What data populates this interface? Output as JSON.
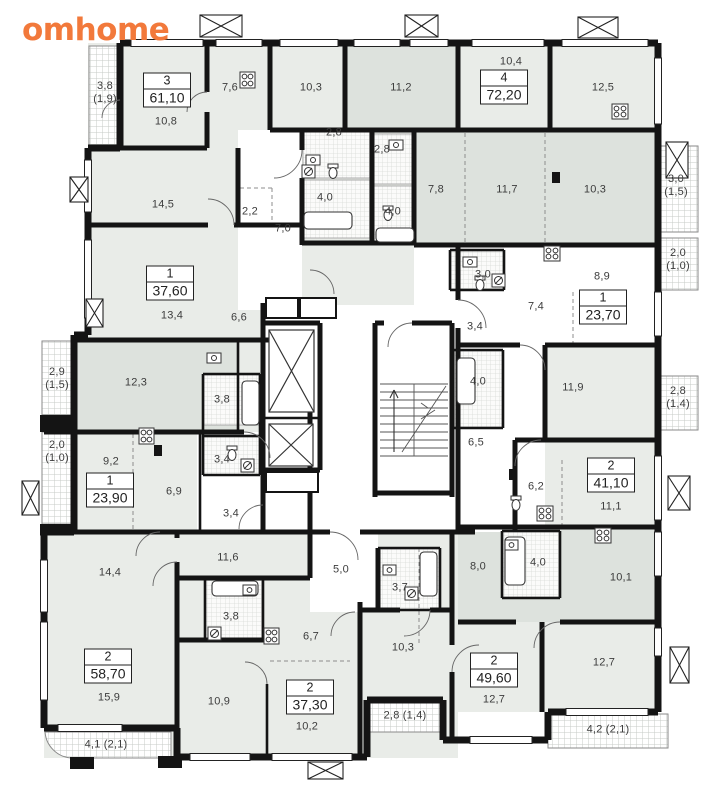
{
  "logo": {
    "text": "omhome",
    "color": "#F2793B"
  },
  "plan": {
    "wall_color": "#141414",
    "room_fill": "#e9ece8",
    "room_fill_dark": "#dde2dd",
    "corridor_fill": "#ffffff",
    "apartments": [
      {
        "number": "3",
        "area": "61,10",
        "x": 167,
        "y": 90
      },
      {
        "number": "4",
        "area": "72,20",
        "x": 504,
        "y": 87
      },
      {
        "number": "1",
        "area": "37,60",
        "x": 170,
        "y": 283
      },
      {
        "number": "1",
        "area": "23,70",
        "x": 603,
        "y": 307
      },
      {
        "number": "1",
        "area": "23,90",
        "x": 110,
        "y": 490
      },
      {
        "number": "2",
        "area": "41,10",
        "x": 611,
        "y": 475
      },
      {
        "number": "2",
        "area": "58,70",
        "x": 108,
        "y": 666
      },
      {
        "number": "2",
        "area": "37,30",
        "x": 310,
        "y": 697
      },
      {
        "number": "2",
        "area": "49,60",
        "x": 494,
        "y": 670
      }
    ],
    "rooms": [
      {
        "label": "3,8\n(1,9)",
        "x": 105,
        "y": 93
      },
      {
        "label": "10,8",
        "x": 166,
        "y": 122
      },
      {
        "label": "7,6",
        "x": 230,
        "y": 88
      },
      {
        "label": "10,3",
        "x": 311,
        "y": 88
      },
      {
        "label": "11,2",
        "x": 401,
        "y": 88
      },
      {
        "label": "2,8",
        "x": 334,
        "y": 133
      },
      {
        "label": "2,8",
        "x": 382,
        "y": 150
      },
      {
        "label": "10,4",
        "x": 511,
        "y": 62
      },
      {
        "label": "12,5",
        "x": 603,
        "y": 88
      },
      {
        "label": "14,5",
        "x": 163,
        "y": 205
      },
      {
        "label": "2,2",
        "x": 250,
        "y": 212
      },
      {
        "label": "7,0",
        "x": 283,
        "y": 229
      },
      {
        "label": "4,0",
        "x": 325,
        "y": 198
      },
      {
        "label": "4,0",
        "x": 393,
        "y": 212
      },
      {
        "label": "7,8",
        "x": 436,
        "y": 190
      },
      {
        "label": "11,7",
        "x": 507,
        "y": 190
      },
      {
        "label": "10,3",
        "x": 595,
        "y": 190
      },
      {
        "label": "3,0\n(1,5)",
        "x": 676,
        "y": 186
      },
      {
        "label": "2,0\n(1,0)",
        "x": 678,
        "y": 260
      },
      {
        "label": "8,9",
        "x": 602,
        "y": 277
      },
      {
        "label": "3,0",
        "x": 483,
        "y": 275
      },
      {
        "label": "7,4",
        "x": 536,
        "y": 307
      },
      {
        "label": "3,4",
        "x": 475,
        "y": 327
      },
      {
        "label": "13,4",
        "x": 172,
        "y": 316
      },
      {
        "label": "6,6",
        "x": 239,
        "y": 318
      },
      {
        "label": "12,3",
        "x": 136,
        "y": 383
      },
      {
        "label": "3,8",
        "x": 222,
        "y": 400
      },
      {
        "label": "2,9\n(1,5)",
        "x": 57,
        "y": 379
      },
      {
        "label": "2,0\n(1,0)",
        "x": 57,
        "y": 452
      },
      {
        "label": "3,4",
        "x": 222,
        "y": 460
      },
      {
        "label": "9,2",
        "x": 111,
        "y": 462
      },
      {
        "label": "6,9",
        "x": 174,
        "y": 492
      },
      {
        "label": "3,4",
        "x": 231,
        "y": 514
      },
      {
        "label": "11,9",
        "x": 573,
        "y": 388
      },
      {
        "label": "2,8\n(1,4)",
        "x": 678,
        "y": 398
      },
      {
        "label": "6,5",
        "x": 476,
        "y": 443
      },
      {
        "label": "6,2",
        "x": 536,
        "y": 487
      },
      {
        "label": "11,1",
        "x": 611,
        "y": 507
      },
      {
        "label": "4,0",
        "x": 478,
        "y": 382
      },
      {
        "label": "8,0",
        "x": 478,
        "y": 567
      },
      {
        "label": "4,0",
        "x": 538,
        "y": 563
      },
      {
        "label": "10,1",
        "x": 621,
        "y": 578
      },
      {
        "label": "14,4",
        "x": 110,
        "y": 573
      },
      {
        "label": "11,6",
        "x": 228,
        "y": 558
      },
      {
        "label": "5,0",
        "x": 341,
        "y": 570
      },
      {
        "label": "3,7",
        "x": 400,
        "y": 588
      },
      {
        "label": "3,8",
        "x": 231,
        "y": 617
      },
      {
        "label": "6,7",
        "x": 311,
        "y": 637
      },
      {
        "label": "10,3",
        "x": 403,
        "y": 648
      },
      {
        "label": "15,9",
        "x": 109,
        "y": 698
      },
      {
        "label": "10,9",
        "x": 219,
        "y": 702
      },
      {
        "label": "10,2",
        "x": 307,
        "y": 727
      },
      {
        "label": "2,8 (1,4)",
        "x": 405,
        "y": 716
      },
      {
        "label": "12,7",
        "x": 494,
        "y": 700
      },
      {
        "label": "12,7",
        "x": 604,
        "y": 663
      },
      {
        "label": "4,2 (2,1)",
        "x": 608,
        "y": 730
      },
      {
        "label": "4,1 (2,1)",
        "x": 106,
        "y": 745
      }
    ]
  }
}
